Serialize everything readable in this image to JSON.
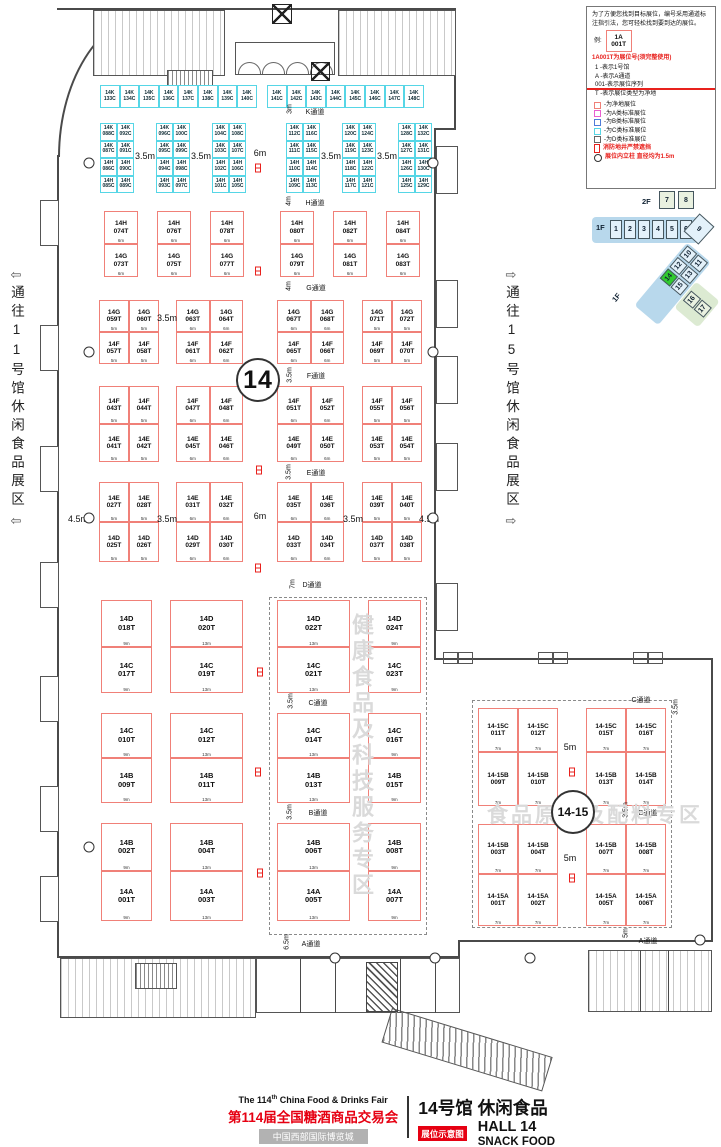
{
  "legend": {
    "intro": "为了方便您找到目标展位，编号采用通道标注指引法，您可轻松找到要到达的展位。",
    "example_label": "例:",
    "example_line1": "1A",
    "example_line2": "001T",
    "headline": "1A001T为展位号(须完整使用)",
    "lines": [
      "1   -表示1号馆",
      "A   -表示A通道",
      "001-表示展位序列",
      "T   -表示展位类型为净地"
    ],
    "key": [
      {
        "color": "#f08078",
        "label": "-为净地展位"
      },
      {
        "color": "#e95ed0",
        "label": "-为A类标准展位"
      },
      {
        "color": "#4f7bd9",
        "label": "-为B类标准展位"
      },
      {
        "color": "#56d6e6",
        "label": "-为C类标准展位"
      },
      {
        "color": "#666666",
        "label": "-为D类标准展位"
      }
    ],
    "note_fire": "消防地井严禁遮挡",
    "note_pillar": "展位内立柱 直径均为1.5m"
  },
  "minimap": {
    "floor2": "2F",
    "floor1": "1F",
    "halls_2f": [
      "7",
      "8"
    ],
    "halls_1f": [
      "1",
      "2",
      "3",
      "4",
      "5",
      "6"
    ],
    "hall_corner": "9",
    "halls_diag": [
      [
        "10",
        "11"
      ],
      [
        "12",
        "13"
      ],
      [
        "14",
        "15"
      ]
    ],
    "halls_side": [
      "16",
      "17"
    ],
    "highlight": "14"
  },
  "side_labels": {
    "left": "通往11号馆休闲食品展区",
    "right": "通往15号馆休闲食品展区",
    "left_arrow": "⇦",
    "right_arrow": "⇨"
  },
  "hall_circle": "14",
  "hall1415_circle": "14-15",
  "watermark_zone1": "健康食品及科技服务专区",
  "watermark_zone2": "食品原料及配料专区",
  "top_strip": {
    "y": 85,
    "h": 23,
    "bw": 19.6,
    "runs": [
      {
        "x": 100,
        "booths": [
          "14K 133C",
          "14K 134C",
          "14K 135C",
          "14K 136C",
          "14K 137C",
          "14K 138C",
          "14K 139C",
          "14K 140C"
        ]
      },
      {
        "x": 267,
        "booths": [
          "14K 141C",
          "14K 142C",
          "14K 143C",
          "14K 144C",
          "14K 145C",
          "14K 146C",
          "14K 147C",
          "14K 148C"
        ]
      }
    ]
  },
  "k_groups": {
    "y": 123,
    "rh": 17.5,
    "cw": 17,
    "groups": [
      {
        "x": 100,
        "rows": [
          [
            "14K 088C",
            "14K 092C"
          ],
          [
            "14K 087C",
            "14K 091C"
          ],
          [
            "14H 086C",
            "14H 090C"
          ],
          [
            "14H 085C",
            "14H 089C"
          ]
        ]
      },
      {
        "x": 156,
        "rows": [
          [
            "14K 096C",
            "14K 100C"
          ],
          [
            "14K 095C",
            "14K 099C"
          ],
          [
            "14H 094C",
            "14H 098C"
          ],
          [
            "14H 093C",
            "14H 097C"
          ]
        ]
      },
      {
        "x": 212,
        "rows": [
          [
            "14K 104C",
            "14K 108C"
          ],
          [
            "14K 103C",
            "14K 107C"
          ],
          [
            "14H 102C",
            "14H 106C"
          ],
          [
            "14H 101C",
            "14H 105C"
          ]
        ]
      },
      {
        "x": 286,
        "rows": [
          [
            "14K 112C",
            "14K 116C"
          ],
          [
            "14K 111C",
            "14K 115C"
          ],
          [
            "14H 110C",
            "14H 114C"
          ],
          [
            "14H 109C",
            "14H 113C"
          ]
        ]
      },
      {
        "x": 342,
        "rows": [
          [
            "14K 120C",
            "14K 124C"
          ],
          [
            "14K 119C",
            "14K 123C"
          ],
          [
            "14H 118C",
            "14H 122C"
          ],
          [
            "14H 117C",
            "14H 121C"
          ]
        ]
      },
      {
        "x": 398,
        "rows": [
          [
            "14K 128C",
            "14K 132C"
          ],
          [
            "14K 127C",
            "14K 131C"
          ],
          [
            "14H 126C",
            "14H 130C"
          ],
          [
            "14H 125C",
            "14H 129C"
          ]
        ]
      }
    ]
  },
  "hg_row": {
    "y": 211,
    "bh": 33,
    "w": 34,
    "wlab": "6m",
    "groups": [
      {
        "x": 104,
        "top": "14H 074T",
        "bottom": "14G 073T"
      },
      {
        "x": 157,
        "top": "14H 076T",
        "bottom": "14G 075T"
      },
      {
        "x": 210,
        "top": "14H 078T",
        "bottom": "14G 077T"
      },
      {
        "x": 280,
        "top": "14H 080T",
        "bottom": "14G 079T"
      },
      {
        "x": 333,
        "top": "14H 082T",
        "bottom": "14G 081T"
      },
      {
        "x": 386,
        "top": "14H 084T",
        "bottom": "14G 083T"
      }
    ]
  },
  "pair_blocks": [
    {
      "y": 300,
      "bh": 32,
      "groups": [
        {
          "x": 99,
          "w": 60,
          "wlab": "5m",
          "top": [
            "14G 059T",
            "14G 060T"
          ],
          "bottom": [
            "14F 057T",
            "14F 058T"
          ]
        },
        {
          "x": 176,
          "w": 67,
          "wlab": "6m",
          "top": [
            "14G 063T",
            "14G 064T"
          ],
          "bottom": [
            "14F 061T",
            "14F 062T"
          ]
        },
        {
          "x": 277,
          "w": 67,
          "wlab": "6m",
          "top": [
            "14G 067T",
            "14G 068T"
          ],
          "bottom": [
            "14F 065T",
            "14F 066T"
          ]
        },
        {
          "x": 362,
          "w": 60,
          "wlab": "5m",
          "top": [
            "14G 071T",
            "14G 072T"
          ],
          "bottom": [
            "14F 069T",
            "14F 070T"
          ]
        }
      ]
    },
    {
      "y": 386,
      "bh": 38,
      "groups": [
        {
          "x": 99,
          "w": 60,
          "wlab": "5m",
          "top": [
            "14F 043T",
            "14F 044T"
          ],
          "bottom": [
            "14E 041T",
            "14E 042T"
          ]
        },
        {
          "x": 176,
          "w": 67,
          "wlab": "6m",
          "top": [
            "14F 047T",
            "14F 048T"
          ],
          "bottom": [
            "14E 045T",
            "14E 046T"
          ]
        },
        {
          "x": 277,
          "w": 67,
          "wlab": "6m",
          "top": [
            "14F 051T",
            "14F 052T"
          ],
          "bottom": [
            "14E 049T",
            "14E 050T"
          ]
        },
        {
          "x": 362,
          "w": 60,
          "wlab": "5m",
          "top": [
            "14F 055T",
            "14F 056T"
          ],
          "bottom": [
            "14E 053T",
            "14E 054T"
          ]
        }
      ]
    },
    {
      "y": 482,
      "bh": 40,
      "groups": [
        {
          "x": 99,
          "w": 60,
          "wlab": "5m",
          "top": [
            "14E 027T",
            "14E 028T"
          ],
          "bottom": [
            "14D 025T",
            "14D 026T"
          ]
        },
        {
          "x": 176,
          "w": 67,
          "wlab": "6m",
          "top": [
            "14E 031T",
            "14E 032T"
          ],
          "bottom": [
            "14D 029T",
            "14D 030T"
          ]
        },
        {
          "x": 277,
          "w": 67,
          "wlab": "6m",
          "top": [
            "14E 035T",
            "14E 036T"
          ],
          "bottom": [
            "14D 033T",
            "14D 034T"
          ]
        },
        {
          "x": 362,
          "w": 60,
          "wlab": "5m",
          "top": [
            "14E 039T",
            "14E 040T"
          ],
          "bottom": [
            "14D 037T",
            "14D 038T"
          ]
        }
      ]
    }
  ],
  "lower_block": {
    "cols": [
      {
        "x": 101,
        "w": 51,
        "wlab": "9m"
      },
      {
        "x": 170,
        "w": 73,
        "wlab": "13m"
      },
      {
        "x": 277,
        "w": 73,
        "wlab": "13m"
      },
      {
        "x": 368,
        "w": 53,
        "wlab": "9m"
      }
    ],
    "rows": [
      {
        "y": 600,
        "h1": 47,
        "h2": 46,
        "pairs": [
          [
            "14D 018T",
            "14C 017T"
          ],
          [
            "14D 020T",
            "14C 019T"
          ],
          [
            "14D 022T",
            "14C 021T"
          ],
          [
            "14D 024T",
            "14C 023T"
          ]
        ]
      },
      {
        "y": 713,
        "h1": 45,
        "h2": 45,
        "pairs": [
          [
            "14C 010T",
            "14B 009T"
          ],
          [
            "14C 012T",
            "14B 011T"
          ],
          [
            "14C 014T",
            "14B 013T"
          ],
          [
            "14C 016T",
            "14B 015T"
          ]
        ]
      },
      {
        "y": 823,
        "h1": 48,
        "h2": 50,
        "pairs": [
          [
            "14B 002T",
            "14A 001T"
          ],
          [
            "14B 004T",
            "14A 003T"
          ],
          [
            "14B 006T",
            "14A 005T"
          ],
          [
            "14B 008T",
            "14A 007T"
          ]
        ]
      }
    ]
  },
  "block1415": {
    "cols": [
      478,
      518,
      586,
      626
    ],
    "w": 40,
    "wlab": "7m",
    "rows": [
      {
        "y": 708,
        "h": 44
      },
      {
        "y": 752,
        "h": 54
      },
      {
        "y": 824,
        "h": 50
      },
      {
        "y": 874,
        "h": 52
      }
    ],
    "booths": [
      [
        "14-15C 011T",
        "14-15C 012T",
        "14-15C 015T",
        "14-15C 016T"
      ],
      [
        "14-15B 009T",
        "14-15B 010T",
        "14-15B 013T",
        "14-15B 014T"
      ],
      [
        "14-15B 003T",
        "14-15B 004T",
        "14-15B 007T",
        "14-15B 008T"
      ],
      [
        "14-15A 001T",
        "14-15A 002T",
        "14-15A 005T",
        "14-15A 006T"
      ]
    ]
  },
  "aisle_labels": [
    {
      "t": "K通道",
      "x": 315,
      "y": 112
    },
    {
      "t": "3m",
      "x": 290,
      "y": 109,
      "v": 1
    },
    {
      "t": "H通道",
      "x": 315,
      "y": 203
    },
    {
      "t": "4m",
      "x": 289,
      "y": 201,
      "v": 1
    },
    {
      "t": "G通道",
      "x": 316,
      "y": 288
    },
    {
      "t": "4m",
      "x": 289,
      "y": 286,
      "v": 1
    },
    {
      "t": "F通道",
      "x": 316,
      "y": 376
    },
    {
      "t": "3.5m",
      "x": 290,
      "y": 375,
      "v": 1
    },
    {
      "t": "E通道",
      "x": 316,
      "y": 473
    },
    {
      "t": "3.5m",
      "x": 289,
      "y": 472,
      "v": 1
    },
    {
      "t": "D通道",
      "x": 312,
      "y": 585
    },
    {
      "t": "7m",
      "x": 293,
      "y": 584,
      "v": 1
    },
    {
      "t": "C通道",
      "x": 318,
      "y": 703
    },
    {
      "t": "3.5m",
      "x": 291,
      "y": 701,
      "v": 1
    },
    {
      "t": "B通道",
      "x": 318,
      "y": 813
    },
    {
      "t": "3.5m",
      "x": 290,
      "y": 812,
      "v": 1
    },
    {
      "t": "A通道",
      "x": 311,
      "y": 944
    },
    {
      "t": "6.5m",
      "x": 287,
      "y": 942,
      "v": 1
    },
    {
      "t": "3.5m",
      "x": 145,
      "y": 156,
      "big": 1
    },
    {
      "t": "3.5m",
      "x": 201,
      "y": 156,
      "big": 1
    },
    {
      "t": "6m",
      "x": 260,
      "y": 153,
      "big": 1
    },
    {
      "t": "3.5m",
      "x": 331,
      "y": 156,
      "big": 1
    },
    {
      "t": "3.5m",
      "x": 387,
      "y": 156,
      "big": 1
    },
    {
      "t": "3.5m",
      "x": 167,
      "y": 318,
      "big": 1
    },
    {
      "t": "4.5m",
      "x": 78,
      "y": 519,
      "big": 1
    },
    {
      "t": "3.5m",
      "x": 167,
      "y": 519,
      "big": 1
    },
    {
      "t": "6m",
      "x": 260,
      "y": 516,
      "big": 1
    },
    {
      "t": "3.5m",
      "x": 353,
      "y": 519,
      "big": 1
    },
    {
      "t": "4.5m",
      "x": 429,
      "y": 519,
      "big": 1
    },
    {
      "t": "C通道",
      "x": 641,
      "y": 700
    },
    {
      "t": "3.5m",
      "x": 676,
      "y": 707,
      "v": 1
    },
    {
      "t": "B通道",
      "x": 648,
      "y": 813
    },
    {
      "t": "3.5m",
      "x": 626,
      "y": 810,
      "v": 1
    },
    {
      "t": "A通道",
      "x": 648,
      "y": 941
    },
    {
      "t": "5m",
      "x": 626,
      "y": 933,
      "v": 1
    },
    {
      "t": "5m",
      "x": 570,
      "y": 747,
      "big": 1
    },
    {
      "t": "5m",
      "x": 570,
      "y": 858,
      "big": 1
    }
  ],
  "fire_markers": [
    [
      258,
      168
    ],
    [
      258,
      271
    ],
    [
      258,
      371
    ],
    [
      259,
      470
    ],
    [
      258,
      568
    ],
    [
      260,
      672
    ],
    [
      258,
      772
    ],
    [
      260,
      873
    ],
    [
      572,
      772
    ],
    [
      572,
      878
    ]
  ],
  "pillars": [
    [
      89,
      163
    ],
    [
      89,
      352
    ],
    [
      89,
      518
    ],
    [
      89,
      847
    ],
    [
      433,
      163
    ],
    [
      433,
      352
    ],
    [
      433,
      518
    ],
    [
      335,
      958
    ],
    [
      435,
      958
    ],
    [
      530,
      958
    ],
    [
      700,
      940
    ]
  ],
  "footer": {
    "en_pre": "The 114",
    "en_sup": "th",
    "en_post": " China Food & Drinks Fair",
    "cn_title": "第114届全国糖酒商品交易会",
    "venue": "中国西部国际博览城",
    "hall_cn_1": "14号馆",
    "hall_cn_2": "休闲食品",
    "hall_en": "HALL 14",
    "hall_type_en": "SNACK FOOD",
    "tag": "展位示意图"
  }
}
